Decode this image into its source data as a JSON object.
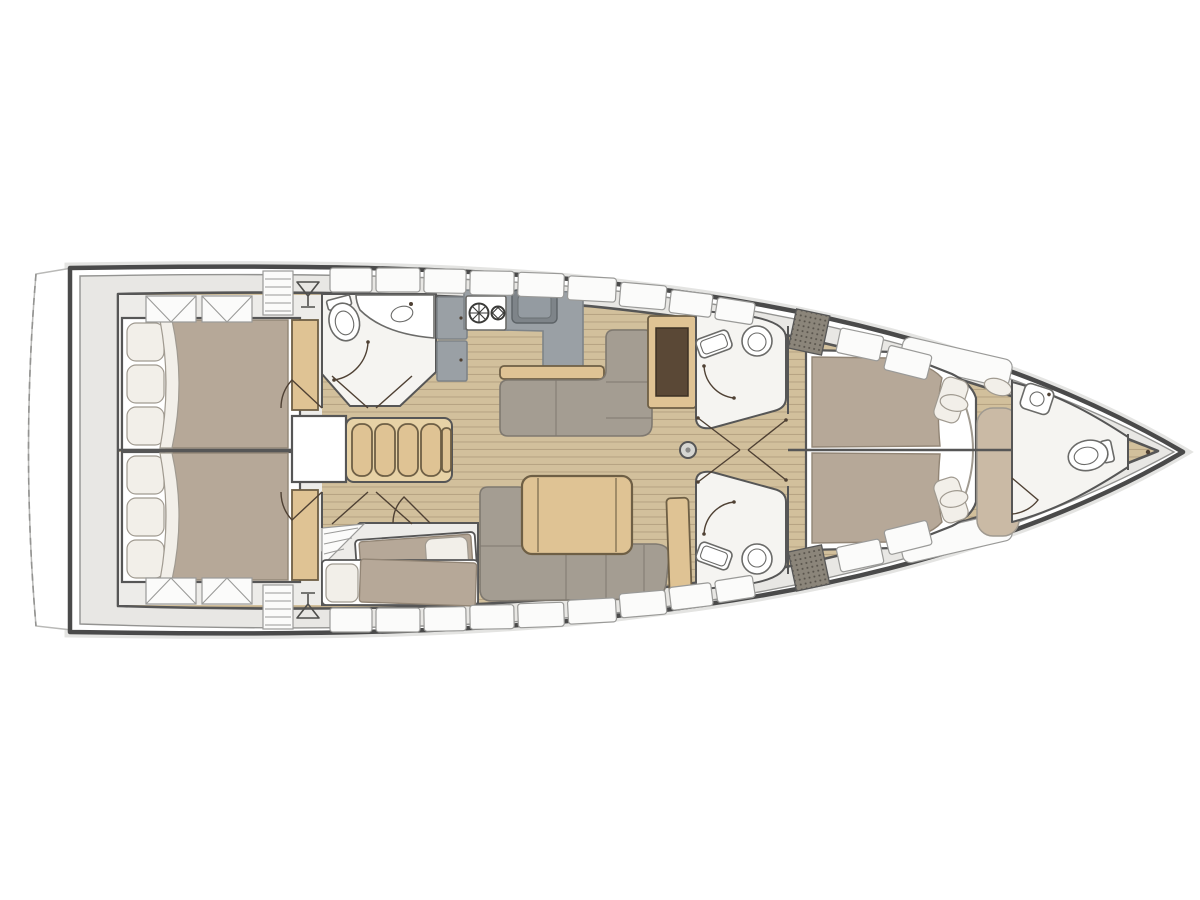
{
  "figure": {
    "label": "Sailing yacht interior layout floor plan, bow pointing right",
    "canvas_width": 1200,
    "canvas_height": 900
  },
  "colors": {
    "hull_outline": "#4a4a4a",
    "hull_inner_line": "#939391",
    "hull_glow": "#e4e4e2",
    "hull_fill": "#ffffff",
    "platform_stroke": "#b9b9b7",
    "deck": "#e8e7e4",
    "panel": "#fbfbfa",
    "panel_stroke": "#9a9a98",
    "wood": "#d2c09c",
    "wood_line": "#b7a483",
    "structure": "#565656",
    "room": "#f5f4f1",
    "cabin_bg": "#edece9",
    "duvet": "#b6a898",
    "duvet_line": "#928575",
    "pillow": "#f2efe9",
    "pillow_stroke": "#a09a90",
    "sofa": "#a49d92",
    "sofa_line": "#7f7970",
    "counter": "#9aa0a5",
    "counter_dark": "#7e8489",
    "table_wood": "#dfc394",
    "step_wood": "#e7d2a6",
    "table_stroke": "#6e5f45",
    "brown": "#5a4836",
    "bench": "#cabaa5",
    "fixture_stroke": "#6b6b69",
    "door": "#4f4134"
  },
  "features": {
    "rooms": [
      "swim-platform",
      "aft-cabin-port",
      "aft-cabin-starboard",
      "aft-head",
      "galley",
      "salon",
      "bunk-cabin",
      "midship-head-port",
      "midship-head-starboard",
      "owner-cabin",
      "bow-head",
      "forepeak"
    ],
    "fixtures": [
      "double-berth",
      "berth-pillows",
      "deck-hatch",
      "wet-bar-glass",
      "louvered-locker",
      "toilet",
      "washbasin",
      "shower-door-arc",
      "stove-two-burners",
      "galley-sink",
      "fridge-lockers",
      "companionway-steps",
      "engine-box",
      "l-settee",
      "chart-table",
      "salon-sofa",
      "folding-table",
      "mast-post",
      "single-berth",
      "island-double-berth",
      "bench-seat",
      "deck-grate",
      "door-swing"
    ]
  }
}
